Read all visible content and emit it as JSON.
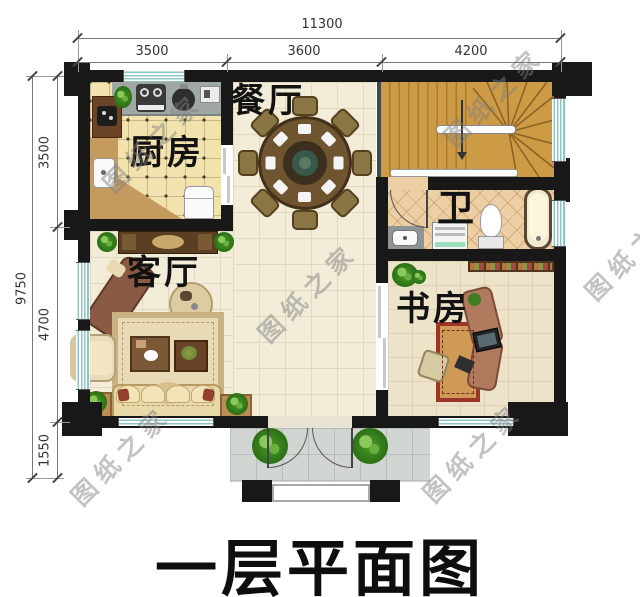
{
  "plan": {
    "title": "一层平面图",
    "watermark": "图纸之家",
    "rooms": {
      "dining": "餐厅",
      "kitchen": "厨房",
      "living": "客厅",
      "bath": "卫",
      "study": "书房"
    },
    "dimensions": {
      "top": {
        "total": "11300",
        "segments": [
          "3500",
          "3600",
          "4200"
        ]
      },
      "left": {
        "total": "9750",
        "segments": [
          "3500",
          "4700",
          "1550"
        ]
      }
    },
    "colors": {
      "wall": "#181818",
      "window_glass": "#8fc4c4",
      "stair_wood": "#cd9a45",
      "floor_cream": "#f2ecd8",
      "kitchen_floor": "#f2e2ad",
      "bath_floor": "#eccfa4",
      "porch_floor": "#d2d6d2",
      "label_text": "#121212"
    }
  }
}
